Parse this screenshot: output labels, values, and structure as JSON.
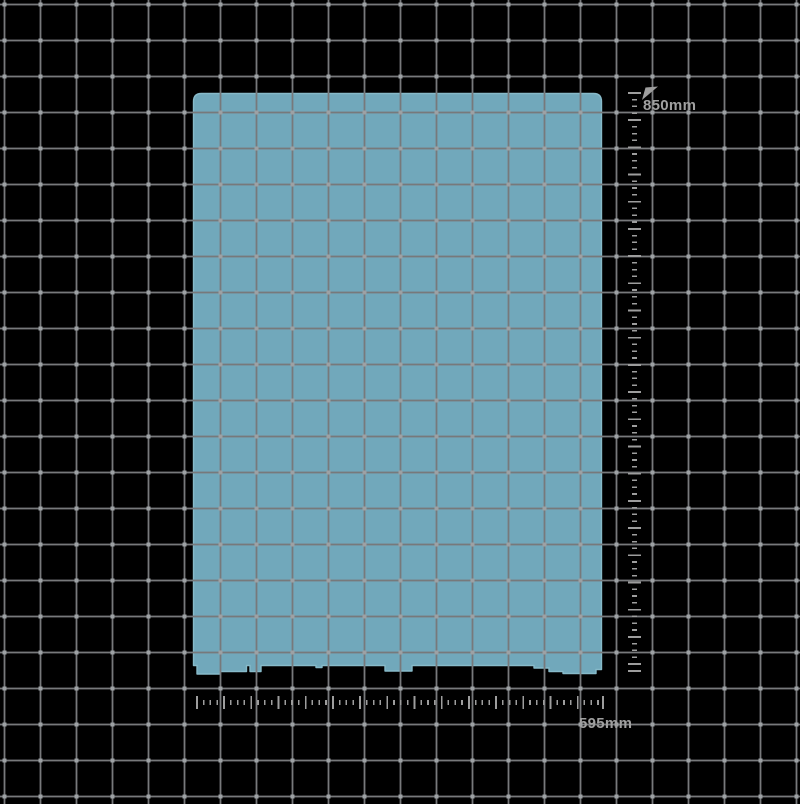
{
  "canvas": {
    "height_dimension": "850mm",
    "width_dimension": "595mm"
  },
  "icons": {
    "dimension_flag": "flag-icon"
  },
  "colors": {
    "background": "#000000",
    "panel-fill": "#71a8bb",
    "panel-edge": "#87bac9",
    "grid-line": "#77797b",
    "grid-node": "#9da1a4",
    "ruler": "#9d9d9d",
    "label": "#a0a0a0"
  }
}
